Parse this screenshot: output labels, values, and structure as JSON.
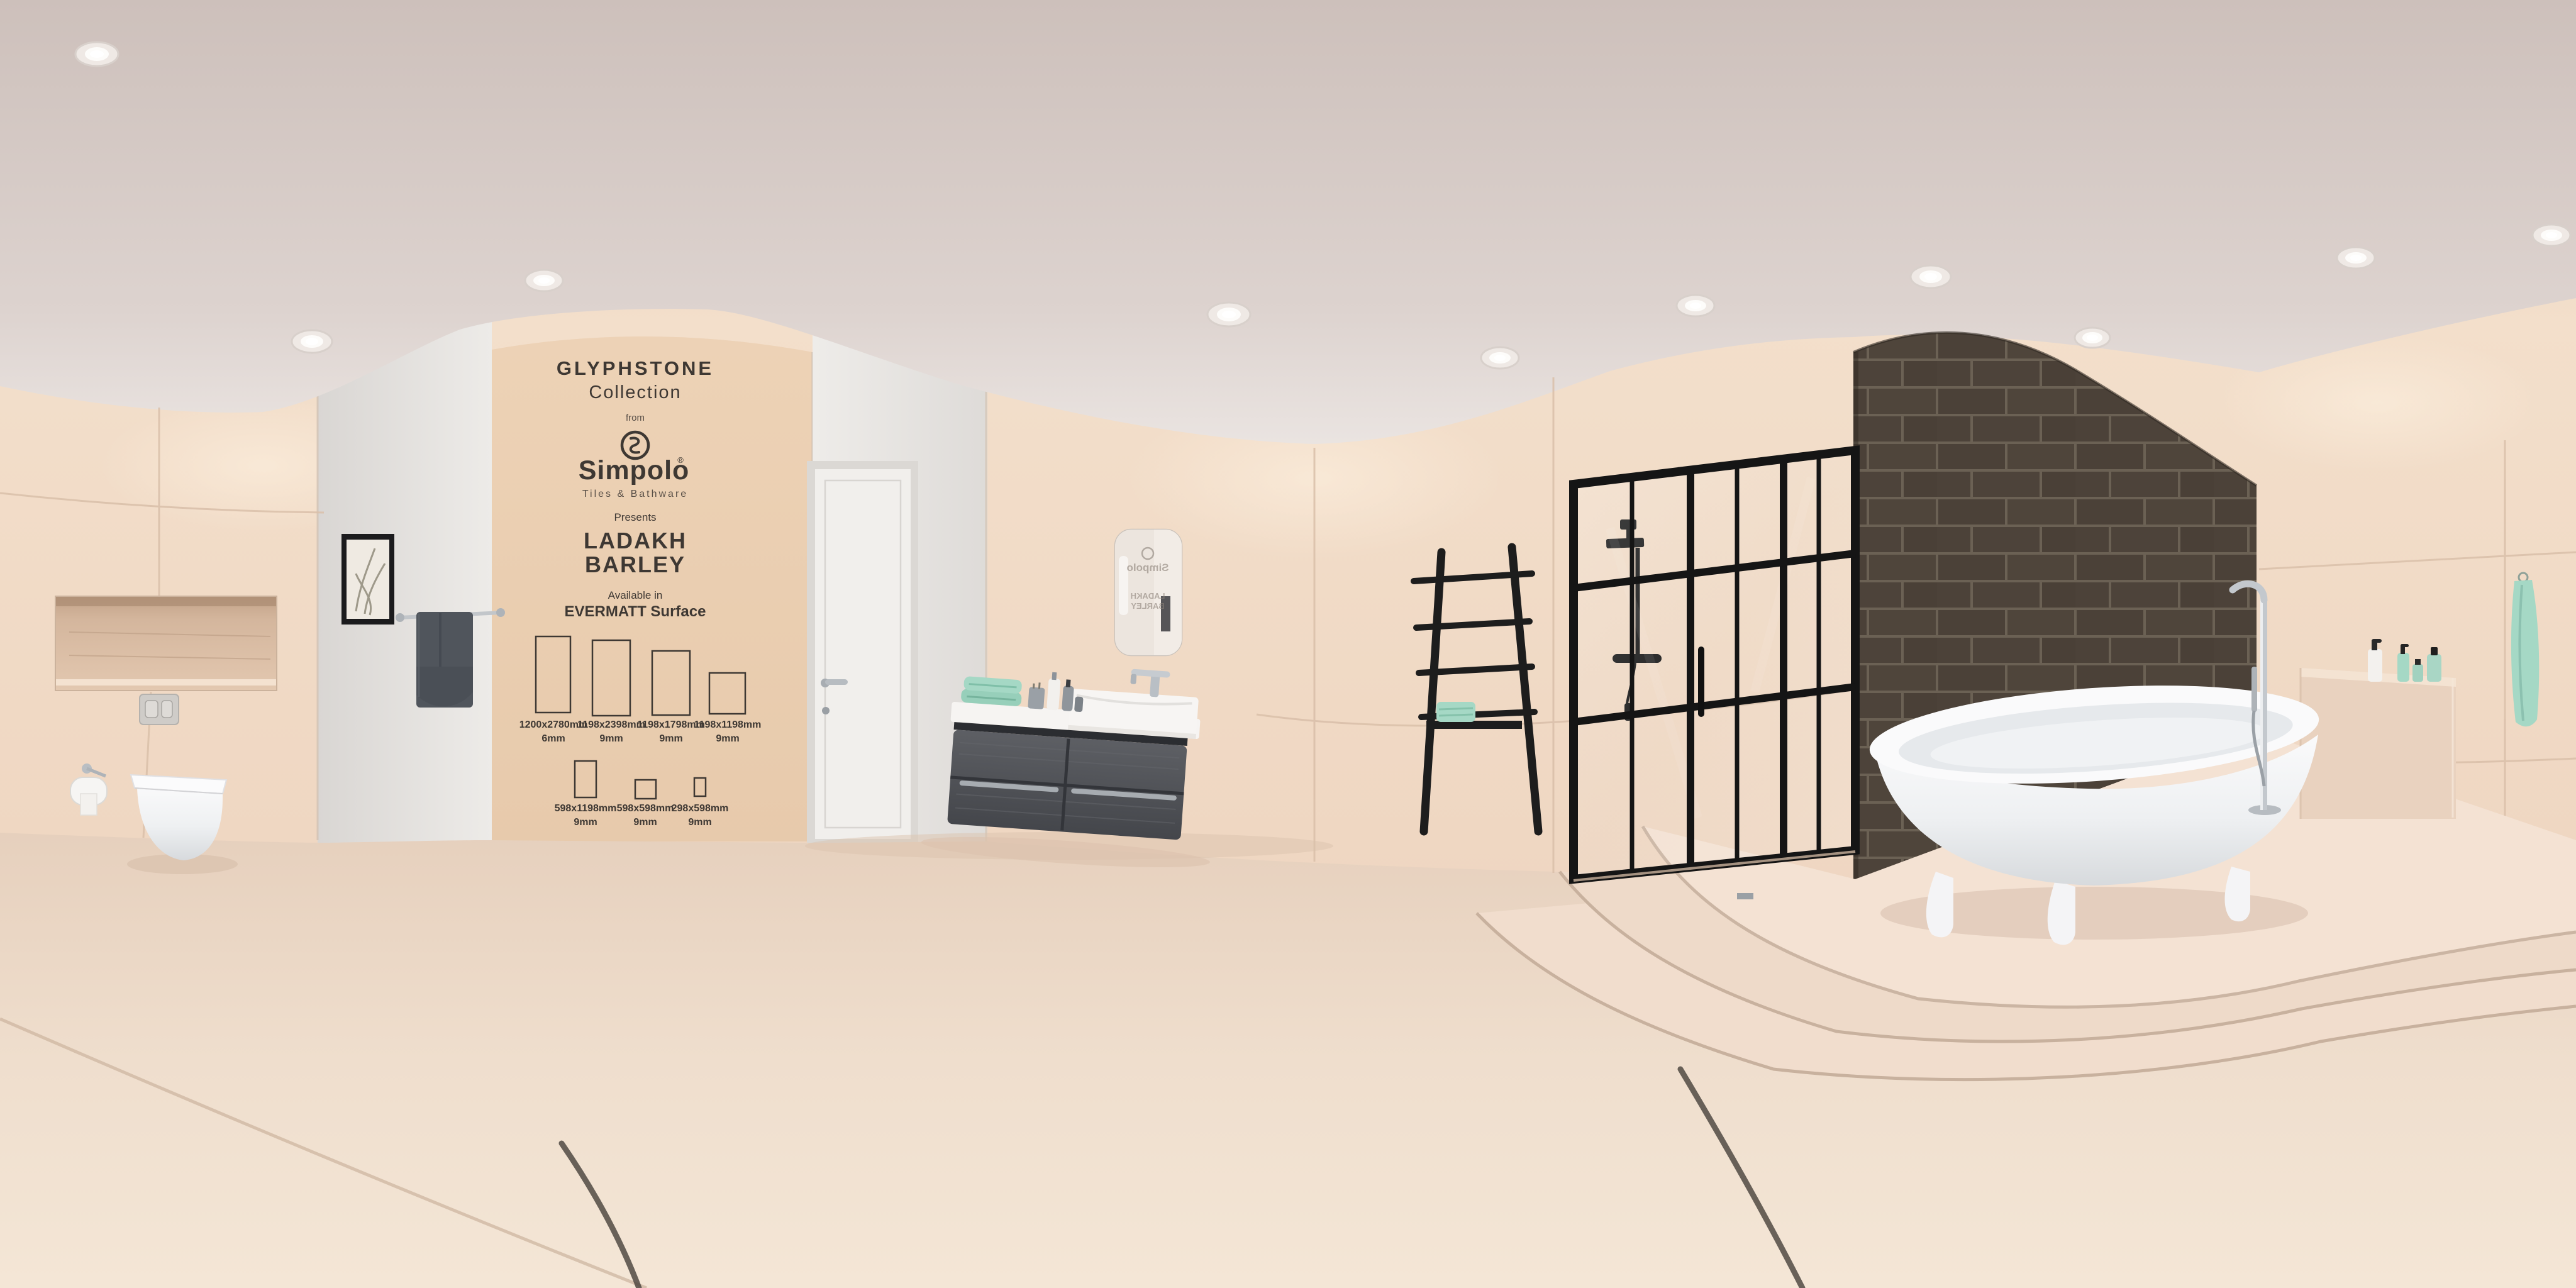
{
  "scene_title": "360-degree bathroom showroom panorama",
  "poster": {
    "collection": "GLYPHSTONE",
    "collection_sub": "Collection",
    "from_label": "from",
    "brand": "Simpolo",
    "registered": "®",
    "tagline": "Tiles & Bathware",
    "presents_label": "Presents",
    "product_line1": "LADAKH",
    "product_line2": "BARLEY",
    "availability_label": "Available in",
    "surface_label": "EVERMATT Surface",
    "tiles_row1": [
      {
        "size": "1200x2780mm",
        "thickness": "6mm"
      },
      {
        "size": "1198x2398mm",
        "thickness": "9mm"
      },
      {
        "size": "1198x1798mm",
        "thickness": "9mm"
      },
      {
        "size": "1198x1198mm",
        "thickness": "9mm"
      }
    ],
    "tiles_row2": [
      {
        "size": "598x1198mm",
        "thickness": "9mm"
      },
      {
        "size": "598x598mm",
        "thickness": "9mm"
      },
      {
        "size": "298x598mm",
        "thickness": "9mm"
      }
    ]
  },
  "mirror_reflection": {
    "brand": "Simpolo",
    "product_line1": "LADAKH",
    "product_line2": "BARLEY"
  },
  "colors": {
    "ink": "#3e3833",
    "poster_panel": "#ebcfb2",
    "wall": "#efd7c3",
    "ceiling": "#d5c9c4",
    "floor": "#eedbc9",
    "dark_brick_wall": "#4b4138",
    "towel_mint": "#a5d8c5",
    "towel_dark": "#50555c",
    "matte_black": "#1b1b1b",
    "chrome": "#b9bec3",
    "fixture_white": "#f7f6f5"
  }
}
